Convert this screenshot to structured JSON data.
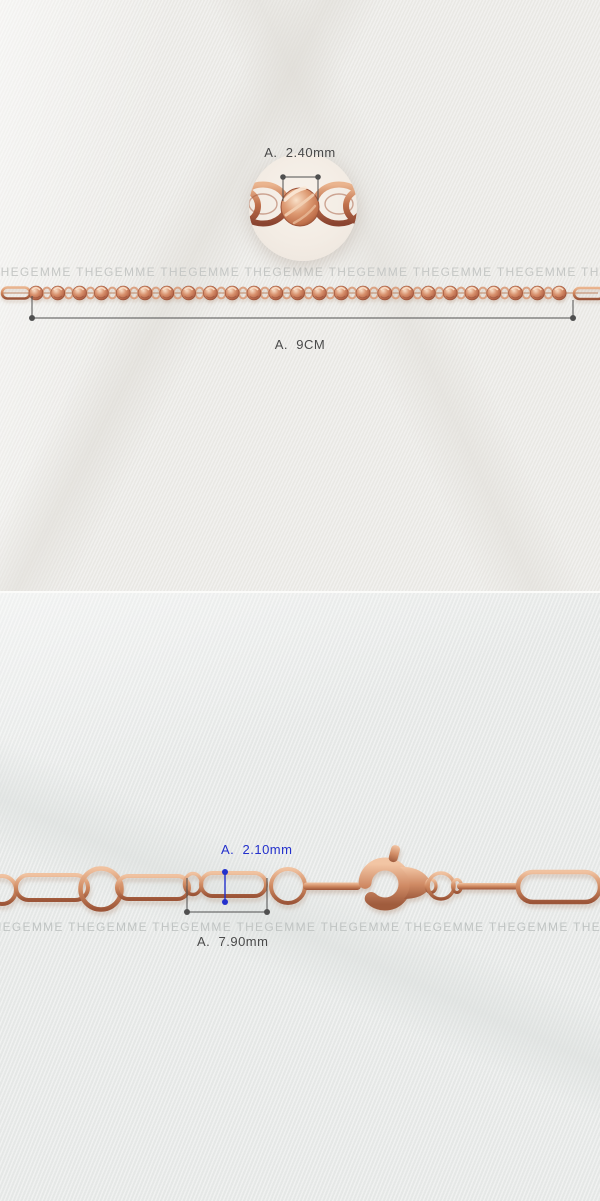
{
  "page": {
    "width": 600,
    "height": 1201,
    "description": "Jewelry shopping-mall detail image: two product photos of a rose-gold chain with size annotations"
  },
  "watermark": {
    "word": "THEGEMME",
    "repeat": 10,
    "color": "#c5c7c5"
  },
  "top_photo": {
    "subject": "faceted bead chain with magnified circular inset",
    "inset_measure_label": "A.  2.40mm",
    "length_measure_label": "A.  9CM",
    "annotation_color": "#4a4a4a"
  },
  "bottom_photo": {
    "subject": "paperclip link chain with lobster clasp",
    "link_height_label": "A.  2.10mm",
    "link_length_label": "A.  7.90mm",
    "height_annotation_color": "#2330cc",
    "length_annotation_color": "#4a4a4a"
  },
  "colors": {
    "rose_gold": "#cd8259",
    "fabric_top": "#ecebe8",
    "fabric_bottom": "#e9ebea",
    "divider": "#fbfbf9"
  }
}
